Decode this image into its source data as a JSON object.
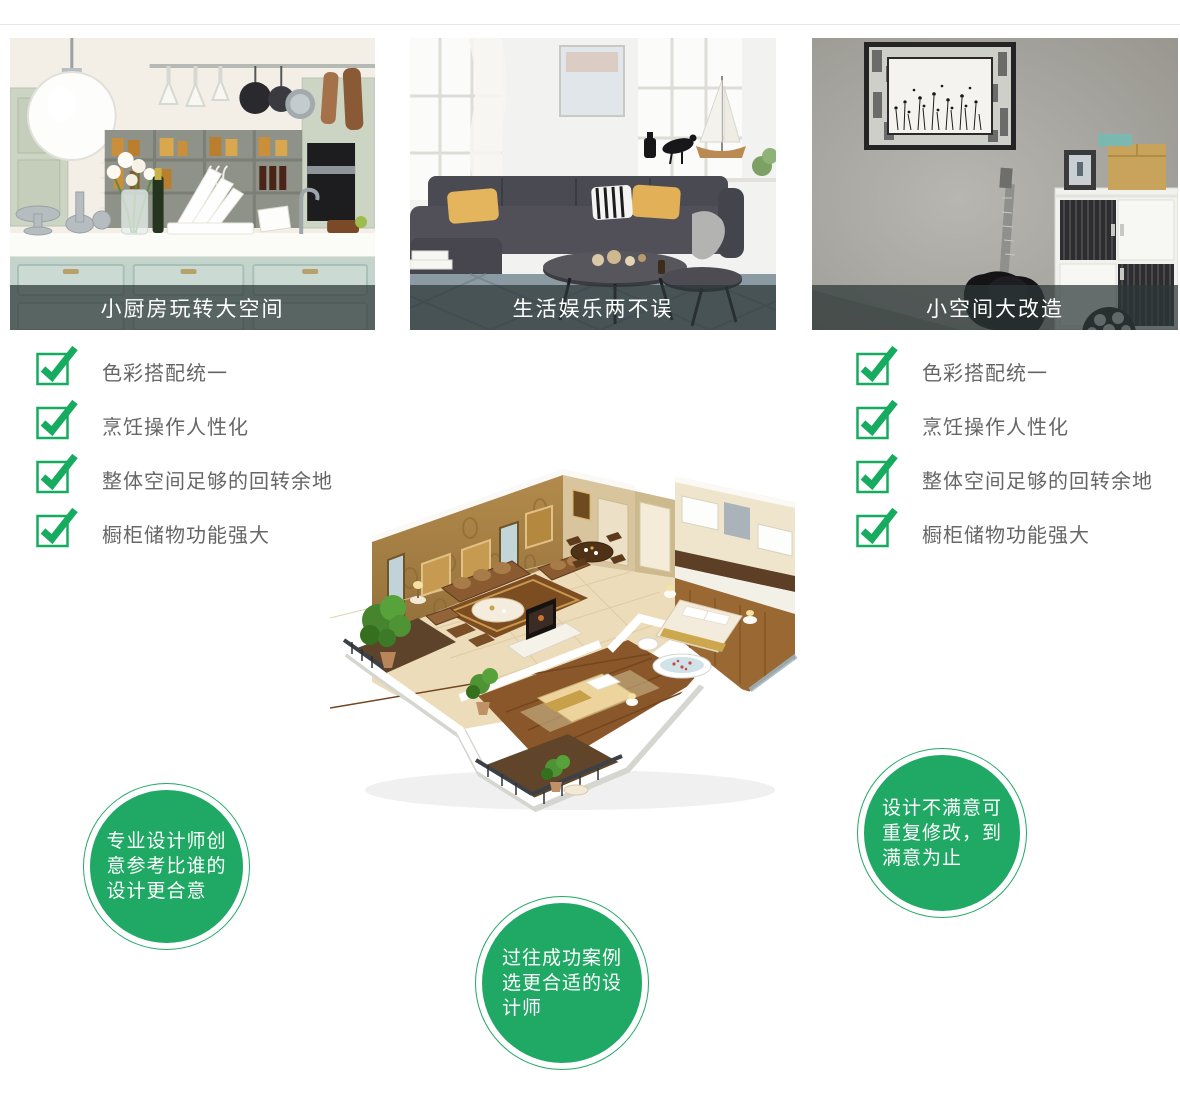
{
  "colors": {
    "accent_green": "#17ab60",
    "bubble_green": "#1fa964",
    "caption_overlay": "rgba(44,55,55,0.72)",
    "checklist_text": "#666666",
    "divider": "#e8e8e8"
  },
  "icons": {
    "check": "green-checkbox-with-checkmark"
  },
  "images": {
    "card_photos": [
      "kitchen-showroom-photo",
      "living-room-sofa-photo",
      "gray-wall-guitar-cabinet-photo"
    ],
    "floorplan": "3d-apartment-floorplan-render"
  },
  "cards": [
    {
      "caption": "小厨房玩转大空间"
    },
    {
      "caption": "生活娱乐两不误"
    },
    {
      "caption": "小空间大改造"
    }
  ],
  "checklists": {
    "left": [
      "色彩搭配统一",
      "烹饪操作人性化",
      "整体空间足够的回转余地",
      "橱柜储物功能强大"
    ],
    "right": [
      "色彩搭配统一",
      "烹饪操作人性化",
      "整体空间足够的回转余地",
      "橱柜储物功能强大"
    ]
  },
  "bubbles": [
    {
      "lines": [
        "专业设计师创",
        "意参考比谁的",
        "设计更合意"
      ]
    },
    {
      "lines": [
        "过往成功案例",
        "选更合适的设",
        "计师"
      ]
    },
    {
      "lines": [
        "设计不满意可",
        "重复修改，到",
        "满意为止"
      ]
    }
  ]
}
